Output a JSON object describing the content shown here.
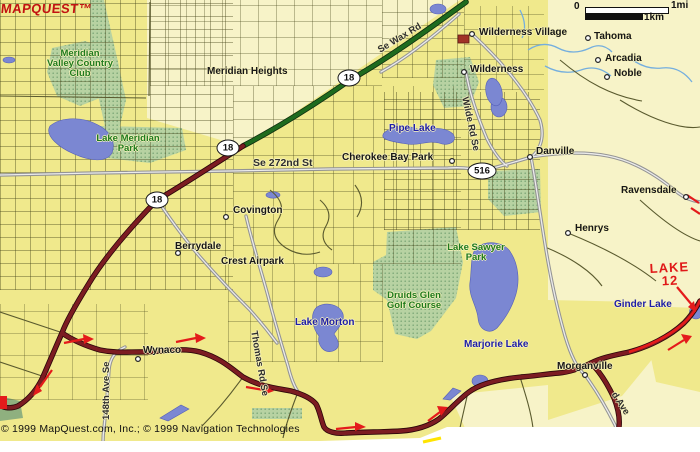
{
  "logo": {
    "text": "MAPQUEST™"
  },
  "scalebar": {
    "zero": "0",
    "mile": "1mi",
    "km": "1km"
  },
  "copyright": "© 1999 MapQuest.com, Inc.; © 1999 Navigation Technologies",
  "annotation": {
    "lake12_line1": "LAKE",
    "lake12_line2": "12"
  },
  "shields": {
    "s18a": "18",
    "s18b": "18",
    "s18c": "18",
    "s516": "516"
  },
  "places": {
    "meridian_heights": "Meridian Heights",
    "wilderness_village": "Wilderness Village",
    "tahoma": "Tahoma",
    "arcadia": "Arcadia",
    "noble": "Noble",
    "wilderness": "Wilderness",
    "cherokee_bay_park": "Cherokee Bay Park",
    "danville": "Danville",
    "ravensdale": "Ravensdale",
    "henrys": "Henrys",
    "covington": "Covington",
    "berrydale": "Berrydale",
    "crest_airpark": "Crest Airpark",
    "morganville": "Morganville",
    "wynaco": "Wynaco"
  },
  "lakes": {
    "pipe_lake": "Pipe Lake",
    "lake_morton": "Lake Morton",
    "marjorie_lake": "Marjorie Lake",
    "ginder_lake": "Ginder Lake"
  },
  "parks": {
    "meridian_valley": [
      "Meridian",
      "Valley Country",
      "Club"
    ],
    "lake_meridian_park": [
      "Lake Meridian",
      "Park"
    ],
    "lake_sawyer_park": [
      "Lake Sawyer",
      "Park"
    ],
    "druids_glen": [
      "Druids Glen",
      "Golf Course"
    ]
  },
  "road_labels": {
    "se_wax_rd": "Se Wax Rd",
    "se_272nd_st": "Se 272nd St",
    "wilde_rd_se": "Wilde Rd Se",
    "ave_148th": "148th Ave Se",
    "thomas_rd_se": "Thomas Rd Se",
    "d_ave": "d Ave"
  },
  "colors": {
    "land_bright": "#f0e98c",
    "land_pale": "#f7f3c8",
    "park_green": "#b7d2a2",
    "water": "#7b87d2",
    "highway_green": "#1e6b1e",
    "highway_maroon": "#7c1c22",
    "annotation_red": "#e41b1b"
  }
}
